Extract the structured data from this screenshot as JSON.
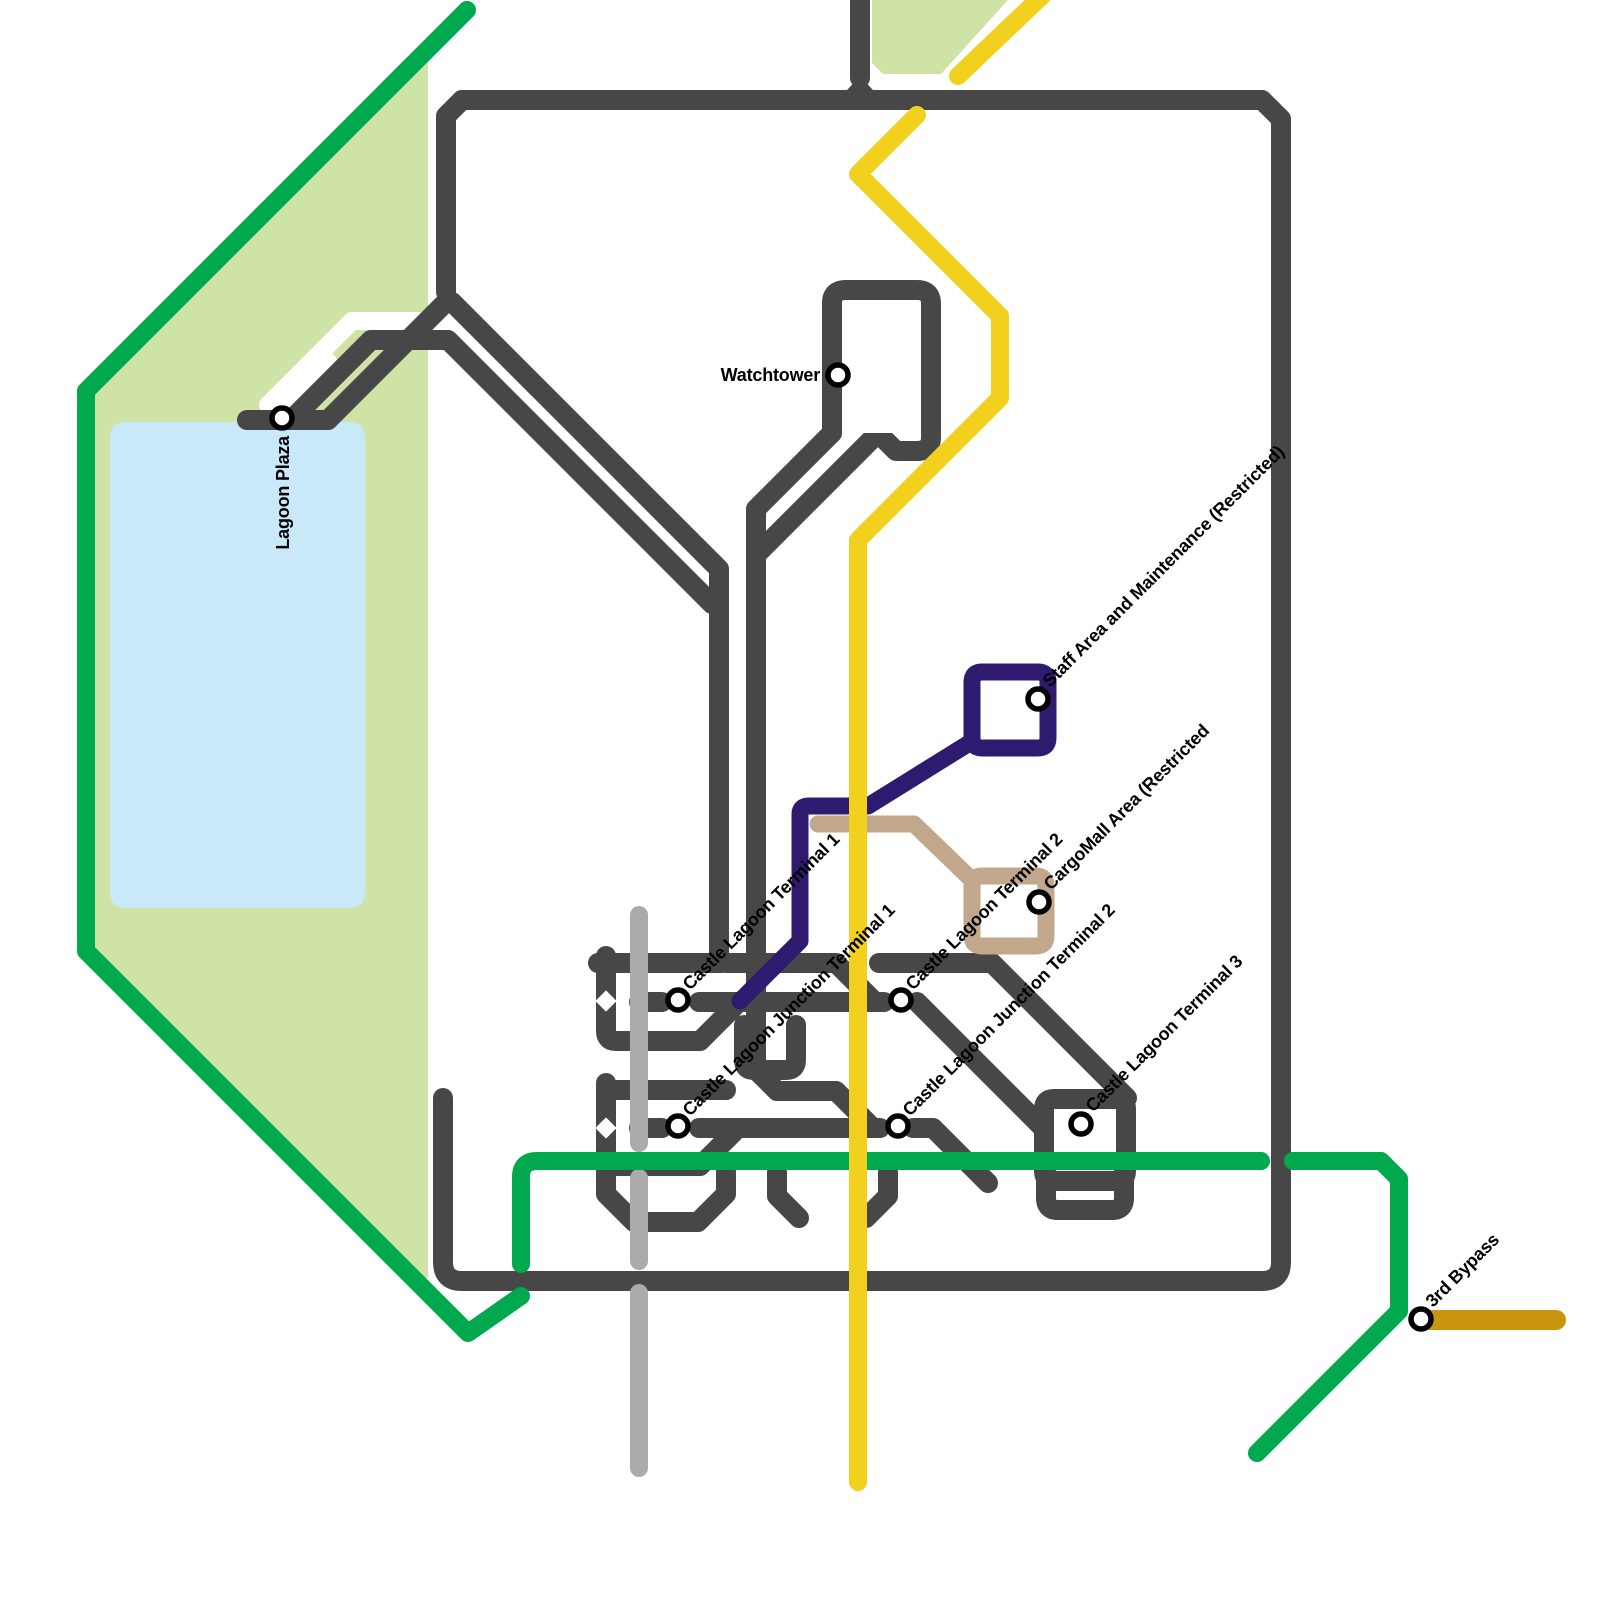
{
  "page": {
    "background": "#ffffff"
  },
  "map": {
    "width": 1600,
    "height": 1600,
    "colors": {
      "road": "#474747",
      "silver": "#ABABAB",
      "yellow": "#F2D01E",
      "dark_yellow": "#C9950C",
      "green": "#00A84E",
      "park": "#CFE3A6",
      "lake": "#C9E8F8",
      "navy": "#2E1A6E",
      "tan": "#C1A78C",
      "label": "#000000",
      "white": "#FFFFFF"
    },
    "areas": [
      {
        "name": "park-area-west",
        "fill": "#CFE3A6",
        "path": "M 467,8 L 86,391 L 86,951 L 420,1286 L 428,1278 L 428,46 Z"
      },
      {
        "name": "park-area-north",
        "fill": "#CFE3A6",
        "path": "M 872,0 L 1008,0 L 941,74 L 883,74 L 872,63 Z"
      },
      {
        "name": "lagoon-lake",
        "fill": "#C9E8F8",
        "path": "M 126,422 H 349 Q 365,422 365,438 V 892 Q 365,908 349,908 H 126 Q 110,908 110,892 V 438 Q 110,422 126,422 Z"
      }
    ],
    "white_gaps": [
      {
        "d": "M 462,321 H 352 L 268,405",
        "width": 18
      },
      {
        "d": "M 330,360 L 287,404",
        "width": 13
      }
    ],
    "roads": {
      "color": "#474747",
      "width": 20,
      "paths": [
        "M 443,1098 V 1262 Q 443,1281 462,1281 H 1262 Q 1281,1281 1281,1262 V 119 L 1262,100 H 462",
        "M 462,100 L 446,116 V 292",
        "M 860,-8 V 78",
        "M 247,420 H 328 L 446,302 H 452 L 719,569 V 963",
        "M 293,418 L 371,340 H 448 L 712,604",
        "M 832,433 L 756,509 V 1070 L 777,1091 H 836 L 871,1126",
        "M 846,290 Q 832,290 832,303 V 433",
        "M 846,290 H 917 Q 931,290 931,304 V 437 Q 931,451 917,451 H 896 L 878,433",
        "M 878,433 L 757,554",
        "M 598,963 H 722",
        "M 606,956 V 1031 Q 606,1041 616,1041 H 700 L 734,1007",
        "M 639,1002 H 662",
        "M 699,1002 H 884",
        "M 917,1002 L 1043,1128",
        "M 727,963 H 836 L 875,1002",
        "M 879,963 H 992 L 1127,1098",
        "M 744,1025 V 1060 Q 744,1070 754,1070 H 786 Q 796,1070 796,1060 V 1025",
        "M 606,1083 V 1156 Q 606,1166 616,1166 H 700 L 734,1132",
        "M 612,1090 H 726",
        "M 639,1128 H 662",
        "M 699,1128 H 880",
        "M 913,1128 H 933 L 988,1183",
        "M 1054,1099 H 1116 Q 1126,1099 1126,1109 V 1171 Q 1126,1181 1116,1181 H 1054 Q 1044,1181 1044,1171 V 1109 Q 1044,1099 1054,1099",
        "M 606,1172 V 1194 L 634,1222 H 698 L 726,1194 V 1172",
        "M 777,1172 V 1196 L 799,1218",
        "M 888,1172 V 1196 L 866,1218",
        "M 1046,1172 V 1198 Q 1046,1210 1058,1210 H 1112 Q 1124,1210 1124,1198 V 1172"
      ],
      "polygons": [
        "836,102 860,76 884,102"
      ]
    },
    "road_cutouts": [
      {
        "type": "path",
        "d": "M 852,324 L 866,310 H 898 Q 910,310 910,322 V 419 L 896,433 H 864 Q 852,433 852,421 Z"
      },
      {
        "type": "diamond",
        "x": 606,
        "y": 1001,
        "s": 15
      },
      {
        "type": "diamond",
        "x": 606,
        "y": 1128,
        "s": 15
      },
      {
        "type": "diamond",
        "x": 1085,
        "y": 1143,
        "s": 26
      }
    ],
    "lines": [
      {
        "name": "silver-line",
        "color": "#ABABAB",
        "width": 18,
        "paths": [
          "M 639,915 V 1143",
          "M 639,1178 V 1261",
          "M 639,1293 V 1468"
        ]
      },
      {
        "name": "green-line",
        "color": "#00A84E",
        "width": 18,
        "paths": [
          "M 467,10 L 86,391 L 86,951 L 468,1333 L 521,1296",
          "M 521,1264 V 1177 Q 521,1161 537,1161 H 1261",
          "M 1293,1161 H 1381 L 1399,1179 V 1311 L 1257,1453"
        ]
      },
      {
        "name": "navy-line",
        "color": "#2E1A6E",
        "width": 17,
        "paths": [
          "M 740,1001 L 800,941 V 814 Q 800,806 809,806 H 868 L 971,742",
          "M 982,672 H 1038 Q 1048,672 1048,682 V 738 Q 1048,748 1038,748 H 982 Q 972,748 972,738 V 682 Q 972,672 982,672"
        ]
      },
      {
        "name": "tan-line",
        "color": "#C1A78C",
        "width": 17,
        "paths": [
          "M 818,824 H 914 L 972,880",
          "M 982,876 H 1036 Q 1046,876 1046,886 V 936 Q 1046,946 1036,946 H 982 Q 972,946 972,936 V 886 Q 972,876 982,876"
        ]
      },
      {
        "name": "yellow-line",
        "color": "#F2D01E",
        "width": 18,
        "paths": [
          "M 1046,-8 L 958,76",
          "M 917,115 L 858,174 L 1000,316 V 398 L 858,540 V 1482"
        ]
      },
      {
        "name": "bypass-line",
        "color": "#C9950C",
        "width": 20,
        "paths": [
          "M 1422,1320 H 1556"
        ]
      }
    ],
    "ring_cutouts": [
      {
        "type": "diamond",
        "x": 1010,
        "y": 710,
        "s": 24
      },
      {
        "type": "diamond",
        "x": 1009,
        "y": 911,
        "s": 22
      }
    ],
    "station_style": {
      "r": 10,
      "stroke": "#000000",
      "stroke_width": 5.5,
      "fill": "#FFFFFF"
    },
    "label_style": {
      "size": 18,
      "weight": "bold",
      "color": "#000000",
      "spacing": "-0.2"
    },
    "stations": [
      {
        "id": "lagoon-plaza",
        "x": 282,
        "y": 418,
        "label": {
          "text": "Lagoon Plaza",
          "rotate": -90,
          "anchor": "end",
          "tx": 289,
          "ty": 436
        }
      },
      {
        "id": "watchtower",
        "x": 838,
        "y": 375,
        "label": {
          "text": "Watchtower",
          "rotate": 0,
          "anchor": "end",
          "tx": 820,
          "ty": 381
        }
      },
      {
        "id": "castle-lagoon-terminal-1",
        "x": 678,
        "y": 1000,
        "label": {
          "text": "Castle Lagoon Terminal 1",
          "rotate": -45,
          "anchor": "start",
          "tx": 690,
          "ty": 991
        }
      },
      {
        "id": "castle-lagoon-junction-terminal-1",
        "x": 678,
        "y": 1126,
        "label": {
          "text": "Castle Lagoon Junction Terminal 1",
          "rotate": -45,
          "anchor": "start",
          "tx": 690,
          "ty": 1117
        }
      },
      {
        "id": "castle-lagoon-terminal-2",
        "x": 901,
        "y": 1000,
        "label": {
          "text": "Castle Lagoon Terminal 2",
          "rotate": -45,
          "anchor": "start",
          "tx": 913,
          "ty": 991
        }
      },
      {
        "id": "castle-lagoon-junction-terminal-2",
        "x": 898,
        "y": 1126,
        "label": {
          "text": "Castle Lagoon Junction Terminal 2",
          "rotate": -45,
          "anchor": "start",
          "tx": 910,
          "ty": 1117
        }
      },
      {
        "id": "castle-lagoon-terminal-3",
        "x": 1081,
        "y": 1124,
        "label": {
          "text": "Castle Lagoon Terminal 3",
          "rotate": -45,
          "anchor": "start",
          "tx": 1093,
          "ty": 1113
        }
      },
      {
        "id": "staff-area-maintenance",
        "x": 1038,
        "y": 699,
        "label": {
          "text": "Staff Area and Maintenance (Restricted)",
          "rotate": -45,
          "anchor": "start",
          "tx": 1050,
          "ty": 688
        }
      },
      {
        "id": "cargomall-area",
        "x": 1039,
        "y": 902,
        "label": {
          "text": "CargoMall Area (Restricted",
          "rotate": -45,
          "anchor": "start",
          "tx": 1051,
          "ty": 891
        }
      },
      {
        "id": "3rd-bypass",
        "x": 1421,
        "y": 1319,
        "label": {
          "text": "3rd Bypass",
          "rotate": -45,
          "anchor": "start",
          "tx": 1433,
          "ty": 1308
        }
      }
    ]
  }
}
